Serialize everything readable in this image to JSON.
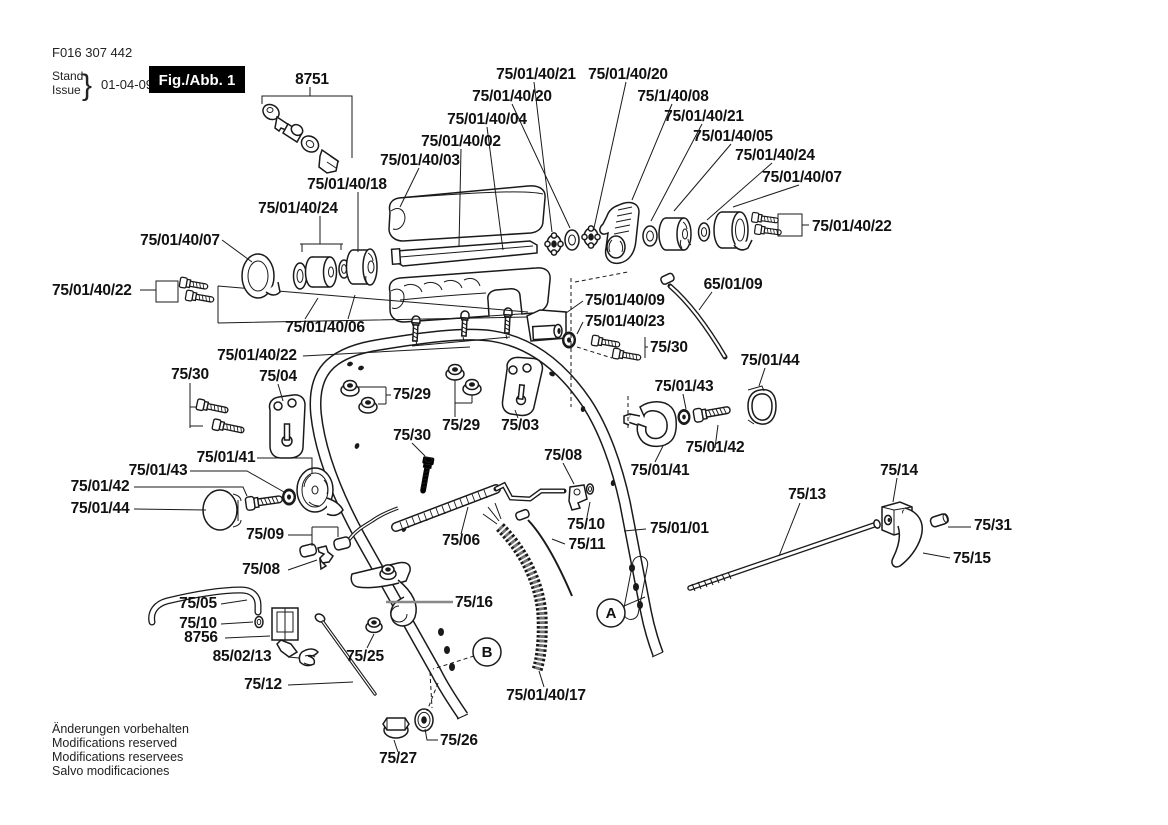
{
  "doc": {
    "part_number": "F016 307 442",
    "stand_label": "Stand",
    "issue_label": "Issue",
    "brace": "}",
    "date": "01-04-09",
    "figure_label": "Fig./Abb. 1"
  },
  "callouts": {
    "a": "A",
    "b": "B"
  },
  "footer": {
    "lines": [
      "Änderungen vorbehalten",
      "Modifications reserved",
      "Modifications reservees",
      "Salvo modificaciones"
    ]
  },
  "labels": [
    "8751",
    "75/01/40/21",
    "75/01/40/20",
    "75/01/40/20",
    "75/1/40/08",
    "75/01/40/04",
    "75/01/40/21",
    "75/01/40/02",
    "75/01/40/05",
    "75/01/40/03",
    "75/01/40/24",
    "75/01/40/18",
    "75/01/40/07",
    "75/01/40/24",
    "75/01/40/22",
    "75/01/40/07",
    "75/01/40/22",
    "65/01/09",
    "75/01/40/09",
    "75/01/40/06",
    "75/01/40/23",
    "75/30",
    "75/01/40/22",
    "75/01/44",
    "75/30",
    "75/04",
    "75/29",
    "75/01/43",
    "75/29",
    "75/03",
    "75/30",
    "75/01/41",
    "75/01/43",
    "75/08",
    "75/01/42",
    "75/01/42",
    "75/01/41",
    "75/14",
    "75/01/44",
    "75/13",
    "75/31",
    "75/09",
    "75/06",
    "75/10",
    "75/11",
    "75/01/01",
    "75/15",
    "75/08",
    "75/16",
    "75/05",
    "75/10",
    "8756",
    "85/02/13",
    "75/25",
    "75/12",
    "75/01/40/17",
    "75/26",
    "75/27"
  ],
  "colors": {
    "ink": "#1a1a1a",
    "paper": "#ffffff"
  }
}
